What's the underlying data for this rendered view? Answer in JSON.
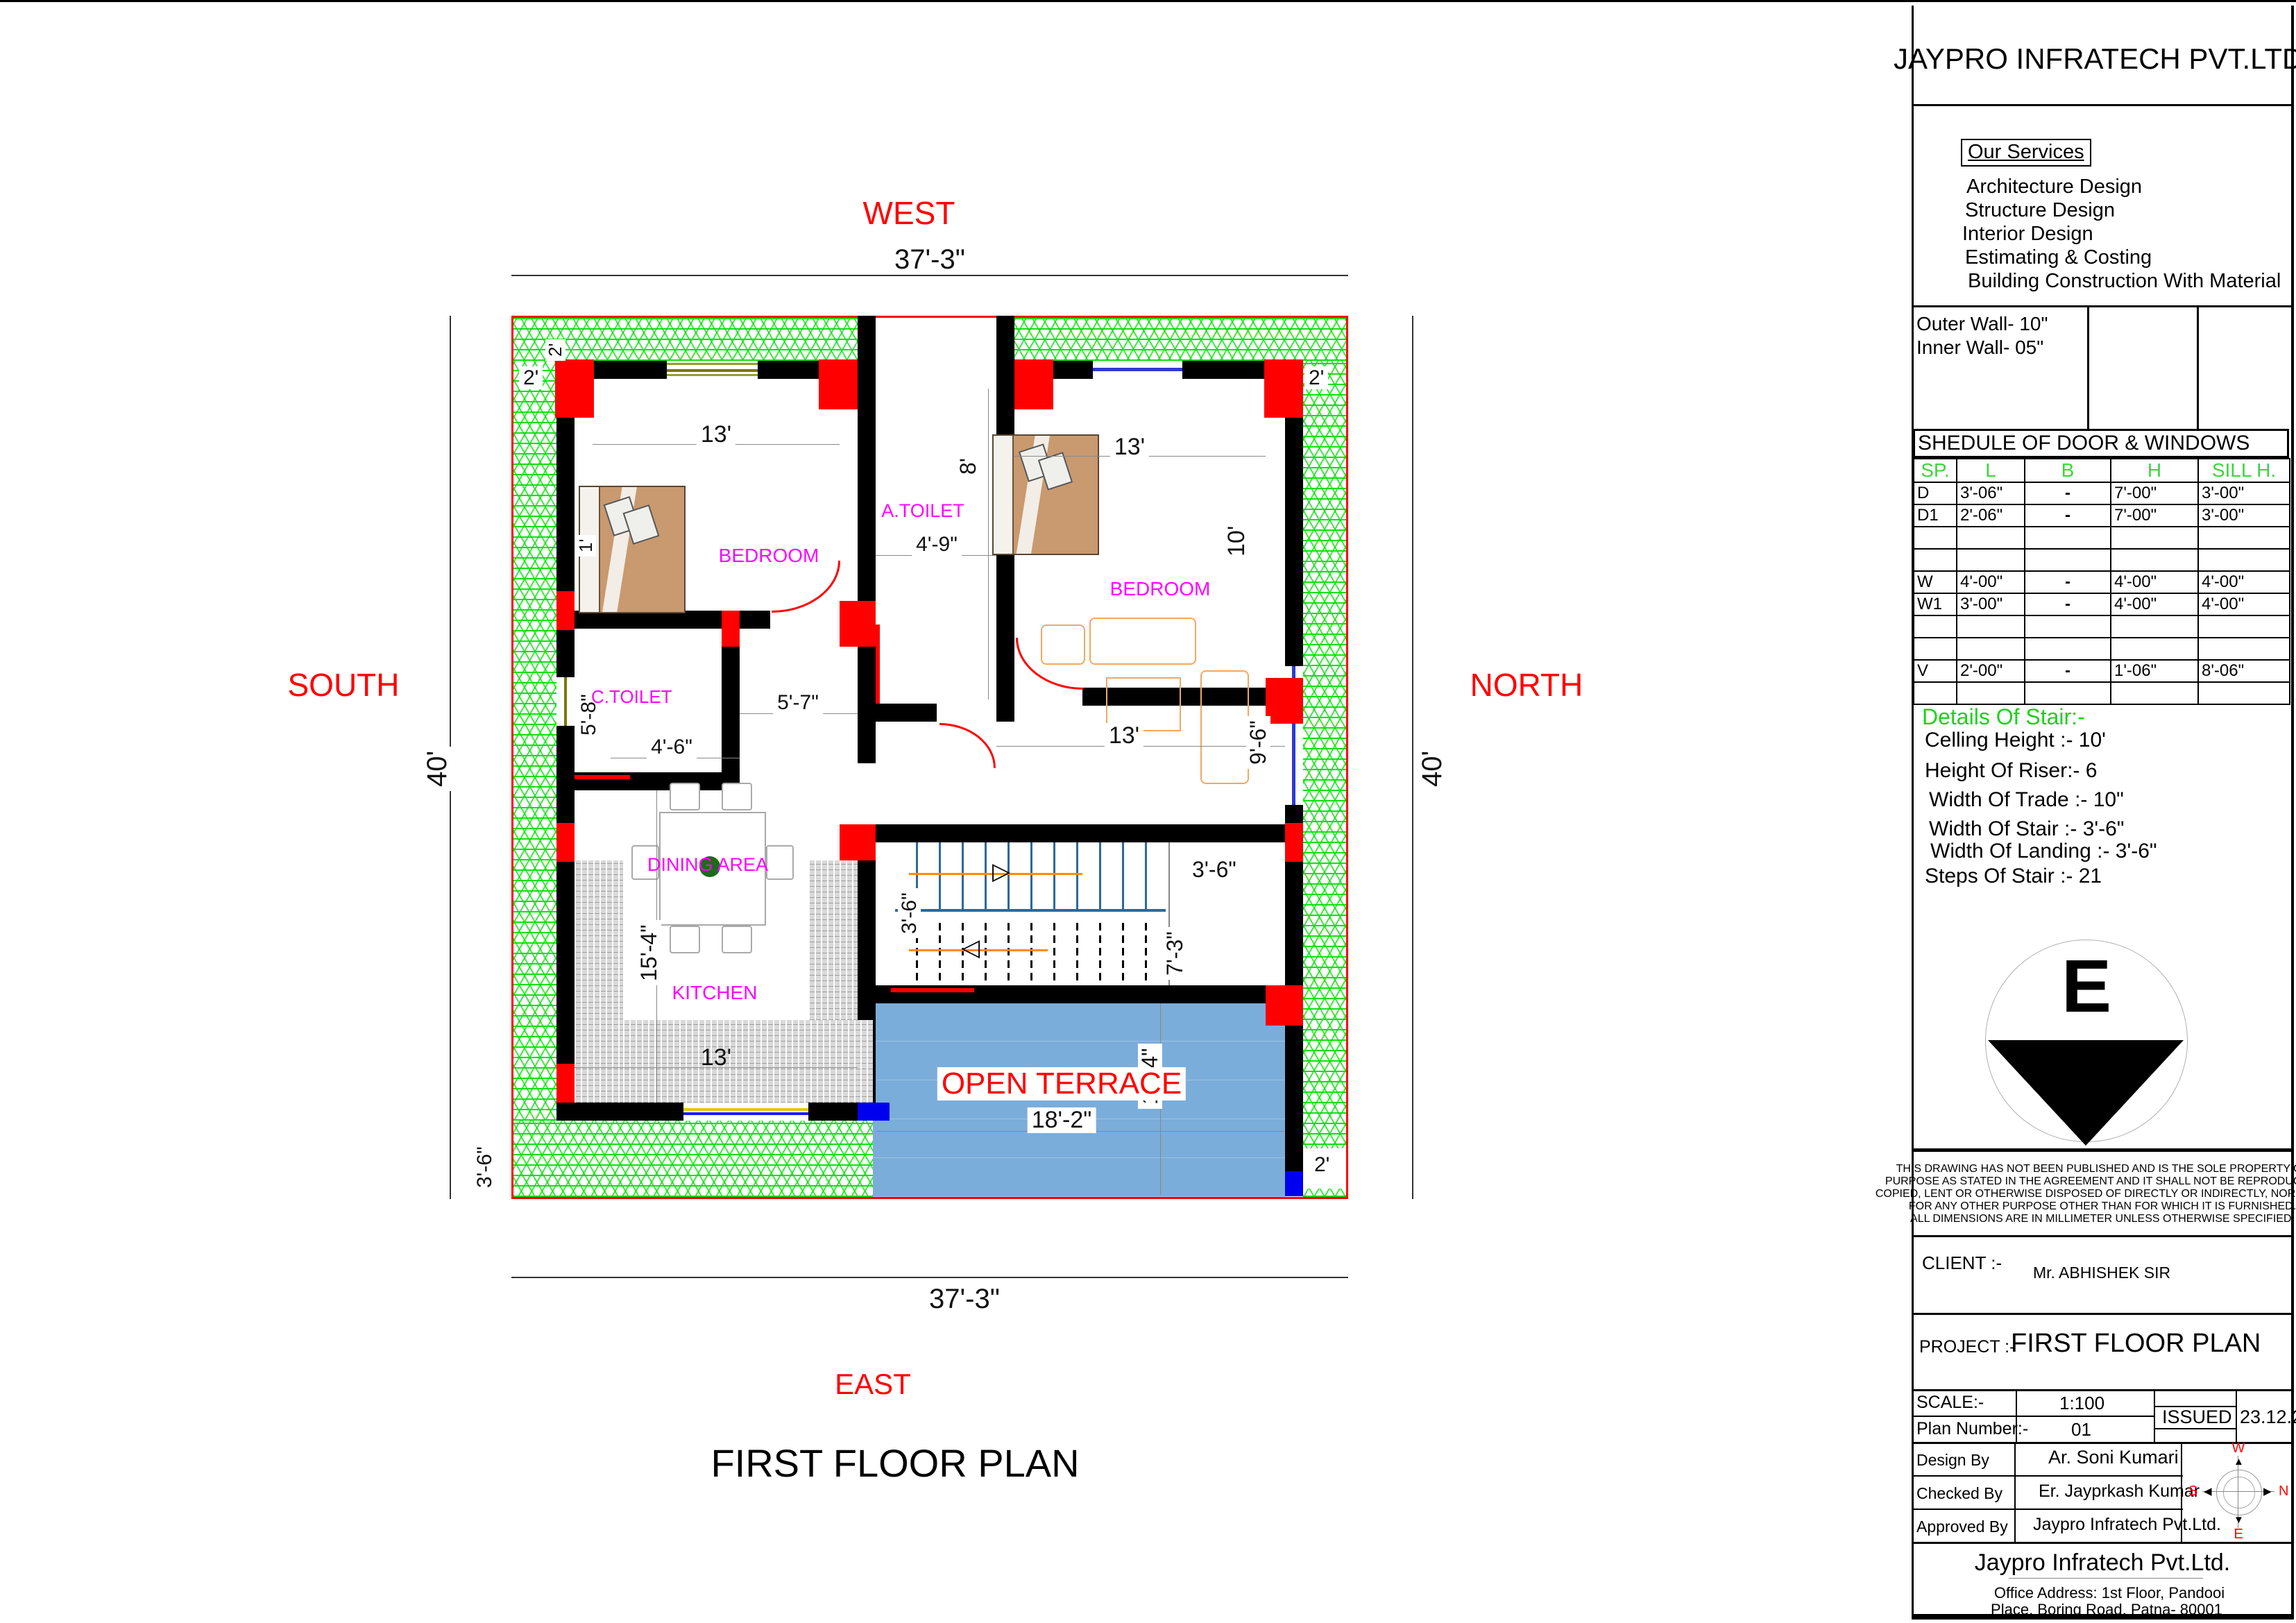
{
  "plan": {
    "title": "FIRST FLOOR PLAN",
    "compass": {
      "west": "WEST",
      "south": "SOUTH",
      "north": "NORTH",
      "east": "EAST"
    },
    "rooms": {
      "bedroom_left": "BEDROOM",
      "bedroom_right": "BEDROOM",
      "a_toilet": "A.TOILET",
      "c_toilet": "C.TOILET",
      "dining": "DINING AREA",
      "kitchen": "KITCHEN",
      "terrace": "OPEN TERRACE"
    },
    "dims": {
      "overall_top": "37'-3\"",
      "overall_bottom": "37'-3\"",
      "overall_left": "40'",
      "overall_right": "40'",
      "border_top_rot": "2'",
      "border_left": "2'",
      "border_right": "2'",
      "border_bottom_right": "2'",
      "border_bottom_left": "3'-6\"",
      "bed1_width": "13'",
      "bed1_note": "1'",
      "atoilet_width": "4'-9\"",
      "atoilet_height": "8'",
      "bed2_width": "13'",
      "bed2_height": "10'",
      "hall_width": "13'",
      "hall_window": "9'-6\"",
      "ctoilet_height": "5'-8\"",
      "ctoilet_width": "4'-6\"",
      "lobby_width": "5'-7\"",
      "dining_height": "15'-4\"",
      "stair_left": "3'-6\"",
      "stair_right": "3'-6\"",
      "stair_height": "7'-3\"",
      "kitchen_width": "13'",
      "terrace_width": "18'-2\"",
      "terrace_height": "13'-4\""
    }
  },
  "sidebar": {
    "company": "JAYPRO INFRATECH PVT.LTD.",
    "services_title": "Our Services",
    "services": [
      "Architecture Design",
      "Structure Design",
      "Interior Design",
      "Estimating & Costing",
      "Building Construction With Material"
    ],
    "walls": {
      "outer": "Outer Wall- 10\"",
      "inner": "Inner  Wall- 05\""
    },
    "schedule": {
      "title": "SHEDULE OF DOOR & WINDOWS",
      "headers": [
        "SP.",
        "L",
        "B",
        "H",
        "SILL H."
      ],
      "rows": [
        {
          "sp": "D",
          "l": "3'-06\"",
          "b": "-",
          "h": "7'-00\"",
          "sill": "3'-00\""
        },
        {
          "sp": "D1",
          "l": "2'-06\"",
          "b": "-",
          "h": "7'-00\"",
          "sill": "3'-00\""
        },
        {
          "sp": "",
          "l": "",
          "b": "",
          "h": "",
          "sill": ""
        },
        {
          "sp": "",
          "l": "",
          "b": "",
          "h": "",
          "sill": ""
        },
        {
          "sp": "W",
          "l": "4'-00\"",
          "b": "-",
          "h": "4'-00\"",
          "sill": "4'-00\""
        },
        {
          "sp": "W1",
          "l": "3'-00\"",
          "b": "-",
          "h": "4'-00\"",
          "sill": "4'-00\""
        },
        {
          "sp": "",
          "l": "",
          "b": "",
          "h": "",
          "sill": ""
        },
        {
          "sp": "",
          "l": "",
          "b": "",
          "h": "",
          "sill": ""
        },
        {
          "sp": "V",
          "l": "2'-00\"",
          "b": "-",
          "h": "1'-06\"",
          "sill": "8'-06\""
        },
        {
          "sp": "",
          "l": "",
          "b": "",
          "h": "",
          "sill": ""
        }
      ]
    },
    "stair_details": {
      "title": "Details Of Stair:-",
      "lines": [
        "Celling Height :- 10'",
        "Height Of Riser:- 6",
        "Width Of Trade :- 10\"",
        "Width Of Stair :- 3'-6\"",
        "Width Of Landing :- 3'-6\"",
        "Steps Of Stair :- 21"
      ]
    },
    "direction_symbol": "E",
    "disclaimer": [
      "THIS DRAWING HAS NOT BEEN PUBLISHED AND IS THE SOLE PROPERTY OF",
      "PURPOSE AS STATED IN THE AGREEMENT AND IT SHALL NOT BE REPRODUCED,",
      "COPIED, LENT OR OTHERWISE DISPOSED OF DIRECTLY OR INDIRECTLY, NOR USED",
      "FOR ANY OTHER PURPOSE OTHER THAN FOR WHICH IT IS FURNISHED.",
      "ALL DIMENSIONS ARE IN MILLIMETER UNLESS OTHERWISE SPECIFIED."
    ],
    "client_label": "CLIENT :-",
    "client": "Mr. ABHISHEK SIR",
    "project_label": "PROJECT :-",
    "project": "FIRST FLOOR PLAN",
    "scale_label": "SCALE:-",
    "scale": "1:100",
    "plan_number_label": "Plan Number:-",
    "plan_number": "01",
    "issued_label": "ISSUED",
    "issued_date": "23.12.25",
    "sign_rows": [
      {
        "label": "Design By",
        "value": "Ar. Soni Kumari"
      },
      {
        "label": "Checked By",
        "value": "Er. Jayprkash Kumar"
      },
      {
        "label": "Approved By",
        "value": "Jaypro Infratech Pvt.Ltd."
      }
    ],
    "mini_compass": {
      "w": "W",
      "n": "N",
      "s": "S",
      "e": "E"
    },
    "footer_company": "Jaypro Infratech Pvt.Ltd.",
    "footer_address1": "Office Address: 1st Floor, Pandooi",
    "footer_address2": "Place, Boring Road, Patna- 80001"
  },
  "colors": {
    "boundary": "#ff0000",
    "lawn_hatch": "#00e100",
    "terrace_fill": "#7badda",
    "room_label": "#ff00ff",
    "schedule_header": "#3cd63c",
    "wall": "#000000"
  }
}
